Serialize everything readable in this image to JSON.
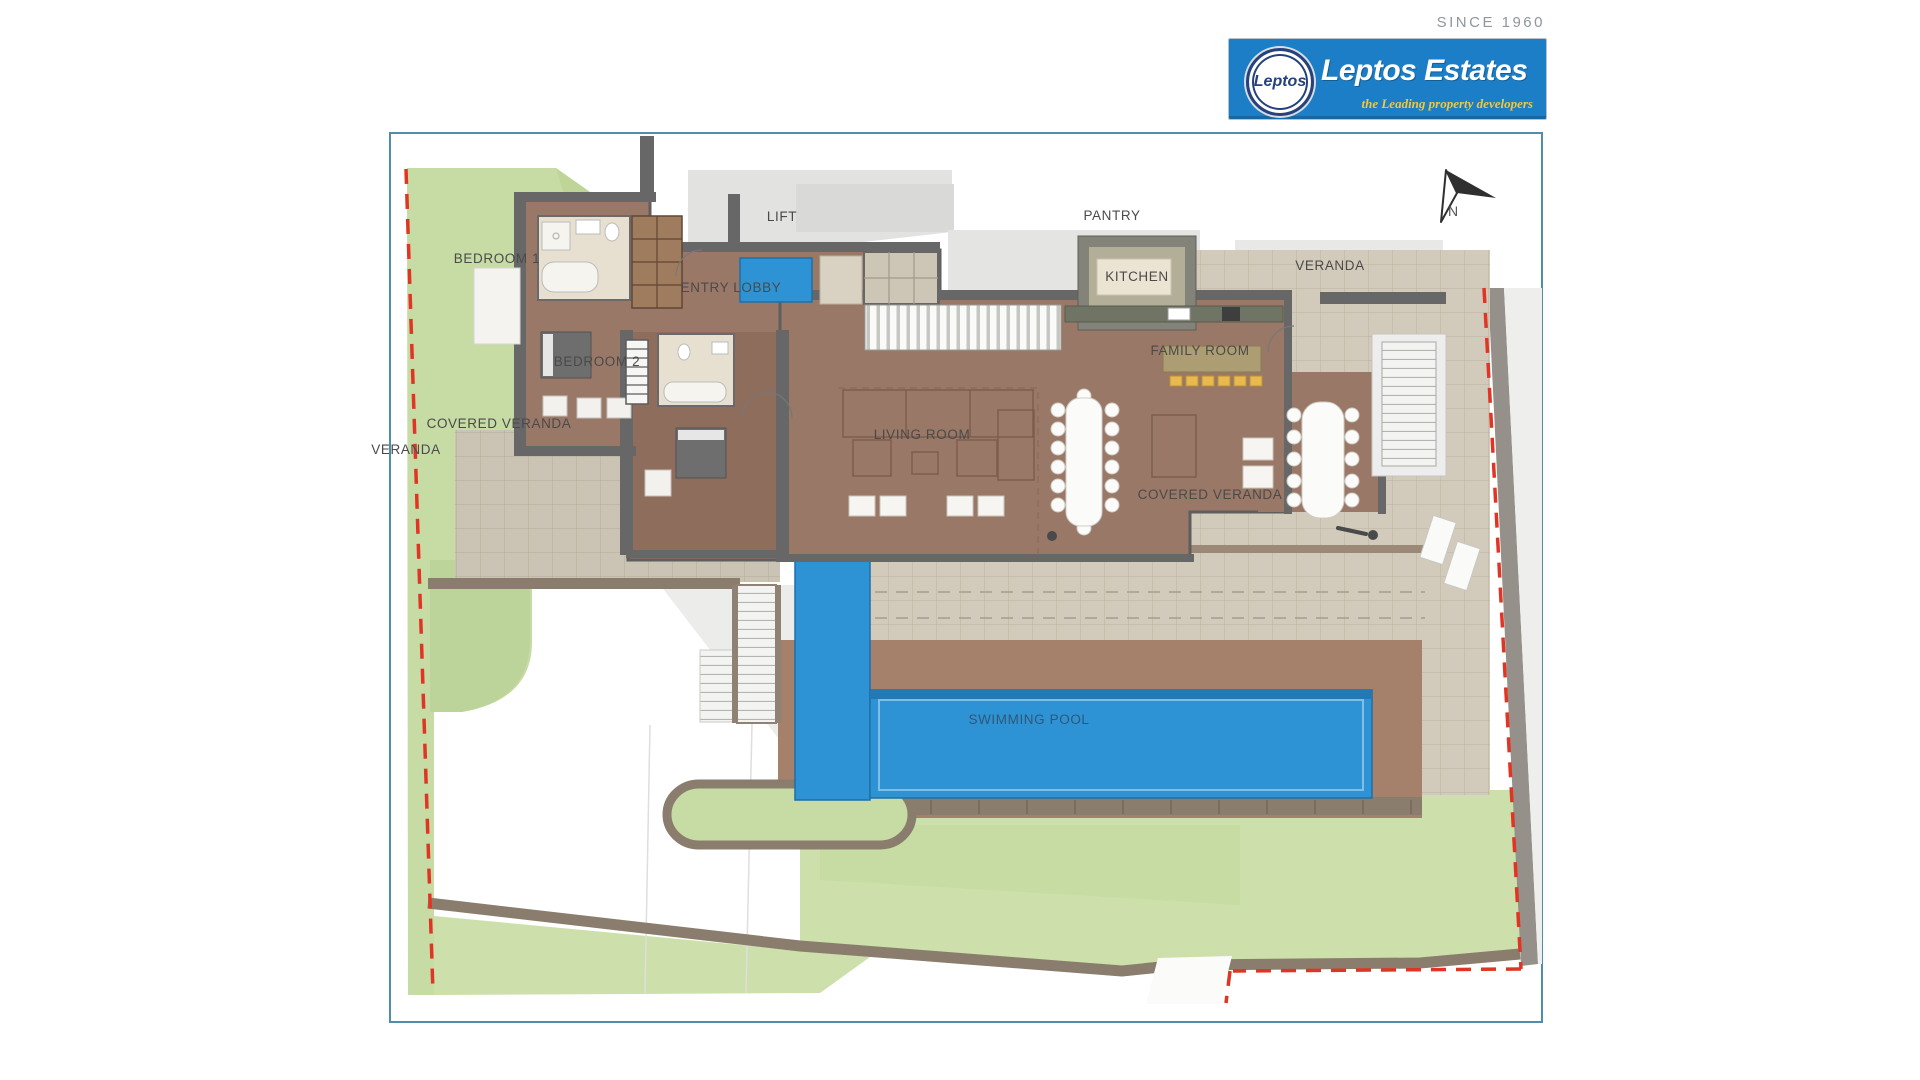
{
  "header": {
    "since_text": "SINCE 1960",
    "logo": {
      "circle_text": "Leptos",
      "brand": "Leptos Estates",
      "tagline": "the Leading property developers"
    }
  },
  "plan": {
    "north_label": "N",
    "labels": [
      {
        "id": "bedroom-1",
        "text": "BEDROOM 1",
        "x": 497,
        "y": 263
      },
      {
        "id": "lift",
        "text": "LIFT",
        "x": 782,
        "y": 221
      },
      {
        "id": "entry-lobby",
        "text": "ENTRY LOBBY",
        "x": 731,
        "y": 292
      },
      {
        "id": "pantry",
        "text": "PANTRY",
        "x": 1112,
        "y": 220
      },
      {
        "id": "kitchen",
        "text": "KITCHEN",
        "x": 1137,
        "y": 281
      },
      {
        "id": "veranda-top",
        "text": "VERANDA",
        "x": 1330,
        "y": 270
      },
      {
        "id": "bedroom-2",
        "text": "BEDROOM 2",
        "x": 597,
        "y": 366
      },
      {
        "id": "family-room",
        "text": "FAMILY ROOM",
        "x": 1200,
        "y": 355
      },
      {
        "id": "covered-veranda-left",
        "text": "COVERED VERANDA",
        "x": 499,
        "y": 428
      },
      {
        "id": "veranda-left",
        "text": "VERANDA",
        "x": 406,
        "y": 454
      },
      {
        "id": "living-room",
        "text": "LIVING ROOM",
        "x": 922,
        "y": 439
      },
      {
        "id": "covered-veranda-right",
        "text": "COVERED VERANDA",
        "x": 1210,
        "y": 499
      },
      {
        "id": "swimming-pool",
        "text": "SWIMMING POOL",
        "x": 1029,
        "y": 724,
        "cls": "pool-label"
      }
    ],
    "colors": {
      "brand_blue": "#1b7ec6",
      "tagline_gold": "#f2c83c",
      "pool_blue": "#2e93d4",
      "lawn_green": "#c7dba4",
      "floor_brown": "#9a7867",
      "boundary_red": "#e03524",
      "frame_border": "#4f8dad"
    }
  }
}
